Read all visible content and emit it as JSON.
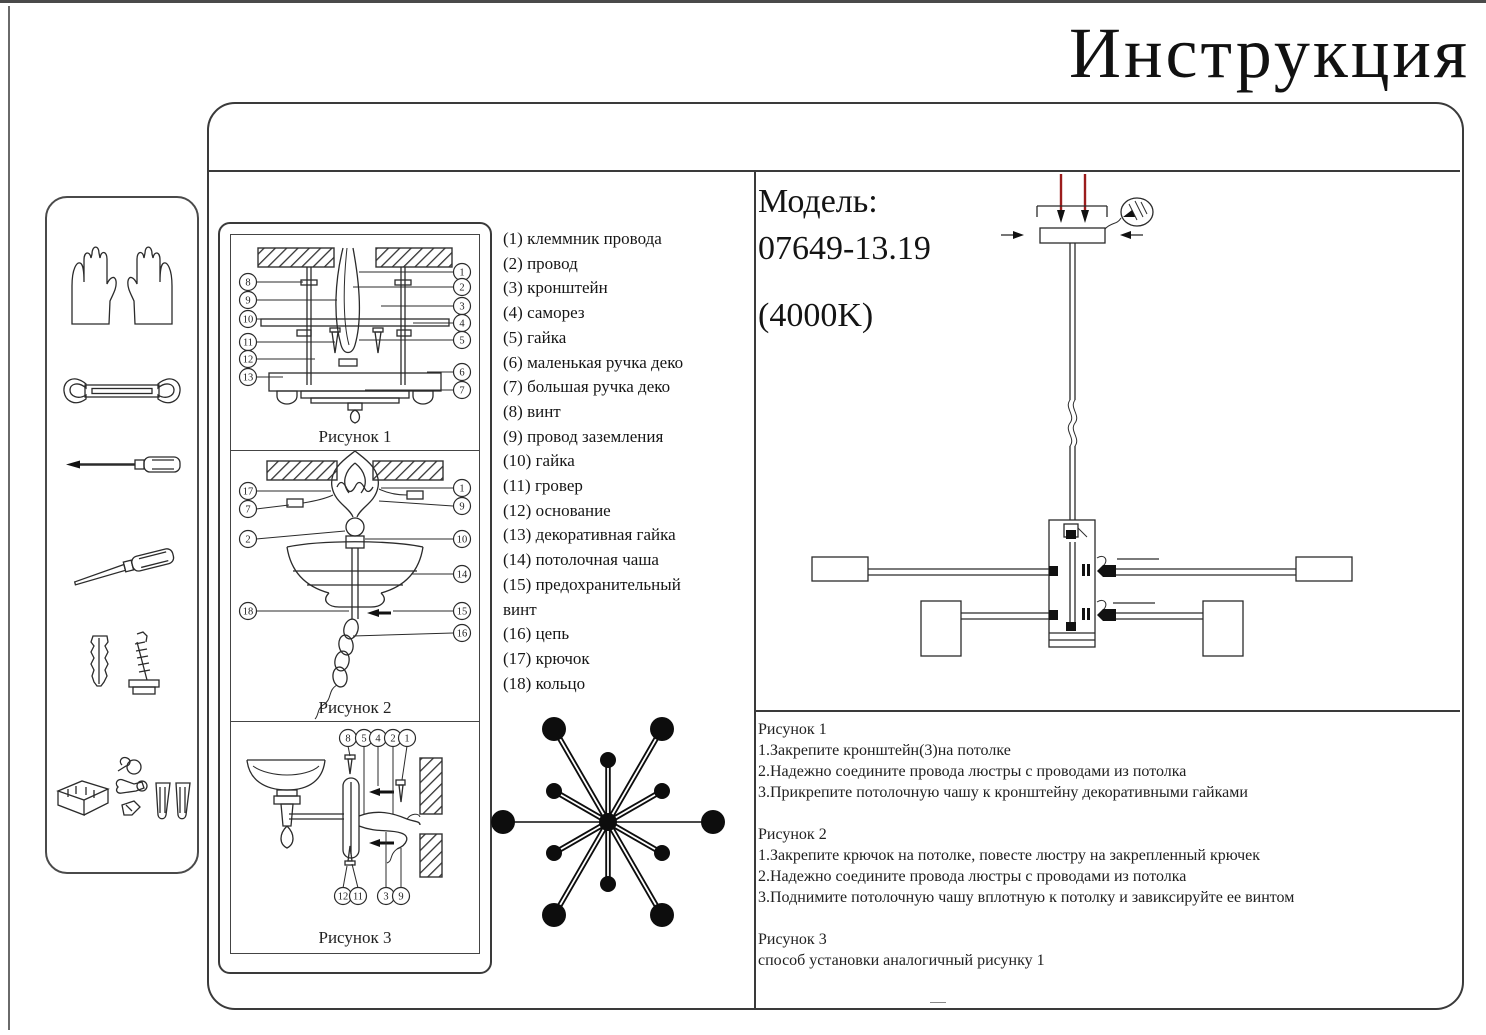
{
  "title": "Инструкция",
  "model": {
    "label": "Модель:",
    "number": "07649-13.19",
    "temperature": "(4000K)"
  },
  "parts": [
    "(1) клеммник провода",
    "(2) провод",
    "(3) кронштейн",
    "(4) саморез",
    "(5) гайка",
    "(6) маленькая ручка деко",
    "(7) большая ручка деко",
    "(8) винт",
    "(9) провод заземления",
    "(10) гайка",
    "(11) гровер",
    "(12) основание",
    "(13) декоративная гайка",
    "(14) потолочная чаша",
    "(15) предохранительный винт",
    "(16) цепь",
    "(17) крючок",
    "(18) кольцо"
  ],
  "figures": {
    "fig1": {
      "caption": "Рисунок 1",
      "left": [
        "8",
        "9",
        "10",
        "11",
        "12",
        "13"
      ],
      "right": [
        "1",
        "2",
        "3",
        "4",
        "5",
        "6",
        "7"
      ]
    },
    "fig2": {
      "caption": "Рисунок 2",
      "left": [
        "17",
        "7",
        "2",
        "18"
      ],
      "right": [
        "1",
        "9",
        "10",
        "14",
        "15",
        "16"
      ]
    },
    "fig3": {
      "caption": "Рисунок 3",
      "top": [
        "8",
        "5",
        "4",
        "2",
        "1"
      ],
      "bottom": [
        "12",
        "11",
        "3",
        "9"
      ]
    }
  },
  "instructions": {
    "fig1_title": "Рисунок 1",
    "fig1_steps": [
      "1.Закрепите кронштейн(3)на потолке",
      "2.Надежно соедините провода люстры с проводами из потолка",
      "3.Прикрепите потолочную чашу к кронштейну декоративными гайками"
    ],
    "fig2_title": "Рисунок 2",
    "fig2_steps": [
      "1.Закрепите крючок на потолке, повесте люстру на закрепленный крючек",
      "2.Надежно соедините провода люстры с проводами из потолка",
      "3.Поднимите потолочную чашу вплотную к потолку и завиксируйте ее винтом"
    ],
    "fig3_title": "Рисунок 3",
    "fig3_steps": [
      "способ установки аналогичный рисунку 1"
    ]
  },
  "sidebar_icons": [
    "gloves",
    "wrench",
    "screwdriver",
    "awl",
    "dowel-and-screw",
    "hardware-set"
  ],
  "colors": {
    "line": "#2b2b2b",
    "red_screw": "#9b1c1c"
  }
}
